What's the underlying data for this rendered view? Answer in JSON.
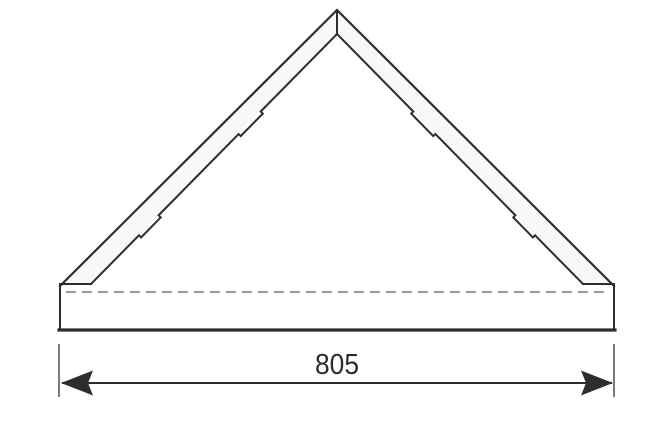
{
  "dimension": {
    "label": "805"
  },
  "colors": {
    "background": "#ffffff",
    "panel-fill": "#f8f8f8",
    "line": "#2d2d2d",
    "hidden-line": "#9a9a9a",
    "dim-line": "#4d4d4d",
    "text": "#2d2d2d"
  }
}
